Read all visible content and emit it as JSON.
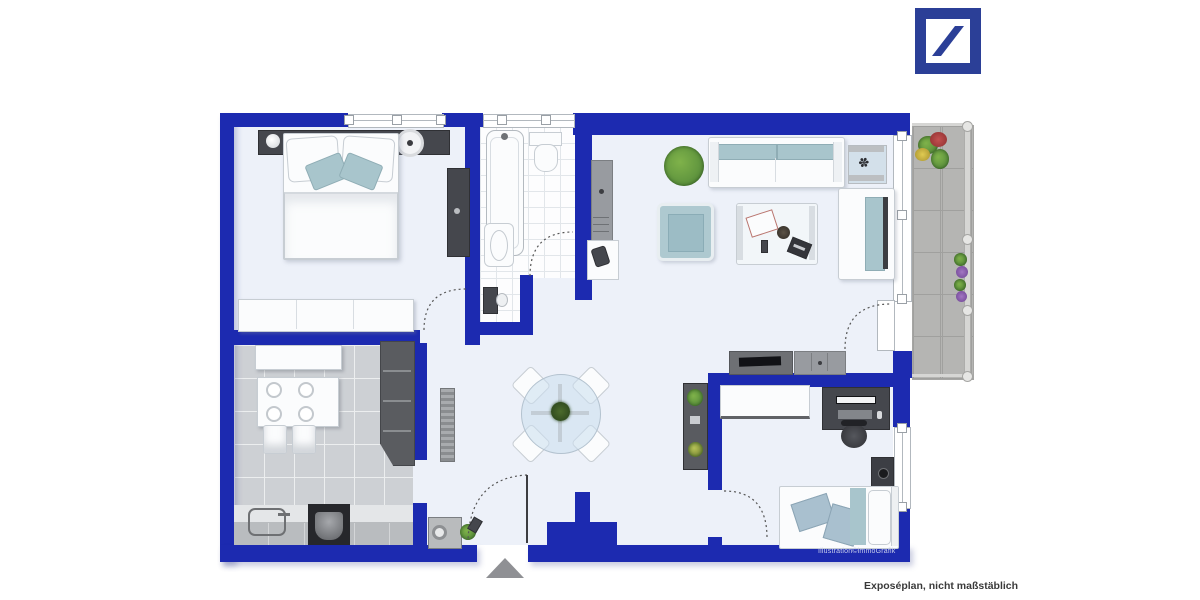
{
  "branding": {
    "logo_icon": "deutsche-bank-slash-logo"
  },
  "plan": {
    "credit": "Illustration©immoGrafik",
    "entrance_marker_icon": "triangle-up-entrance-arrow",
    "rooms": [
      {
        "name": "bedroom",
        "furniture": [
          "double-bed",
          "headboard-with-nightstands",
          "lamp",
          "wardrobe",
          "sideboard"
        ]
      },
      {
        "name": "bathroom",
        "furniture": [
          "bathtub",
          "toilet",
          "sink",
          "wc-nook-toilet"
        ]
      },
      {
        "name": "hallway",
        "furniture": [
          "dresser",
          "side-desk",
          "chair",
          "dining-table-set",
          "washing-machine",
          "tall-cabinet"
        ]
      },
      {
        "name": "living-room",
        "furniture": [
          "sofa",
          "second-sofa",
          "armchair",
          "coffee-table",
          "side-table",
          "plant",
          "tv-lowboard",
          "cabinet",
          "shelf"
        ]
      },
      {
        "name": "kitchen",
        "furniture": [
          "dining-table",
          "chairs",
          "bench",
          "tall-cabinet",
          "counter-with-sink",
          "stove"
        ]
      },
      {
        "name": "office-bedroom",
        "furniture": [
          "desk",
          "computer-desk",
          "office-chair",
          "nightstand",
          "single-bed"
        ]
      },
      {
        "name": "balcony",
        "furniture": [
          "flower-planters",
          "railing"
        ]
      }
    ]
  },
  "footer": {
    "caption": "Exposéplan, nicht maßstäblich"
  },
  "colors": {
    "wall": "#1c2ab0",
    "logo": "#2b3f97",
    "floor": "#edf1f9",
    "floor-kitchen": "#cdd0d4",
    "floor-balcony": "#b5b5b3",
    "teal": "#a8c5cc",
    "dark-furniture": "#45474d",
    "gray-furniture": "#989ba0",
    "plant": "#5f943e",
    "arrow": "#8f9094",
    "text-dark": "#3a3a3a",
    "credit-text": "#c9cfec"
  }
}
